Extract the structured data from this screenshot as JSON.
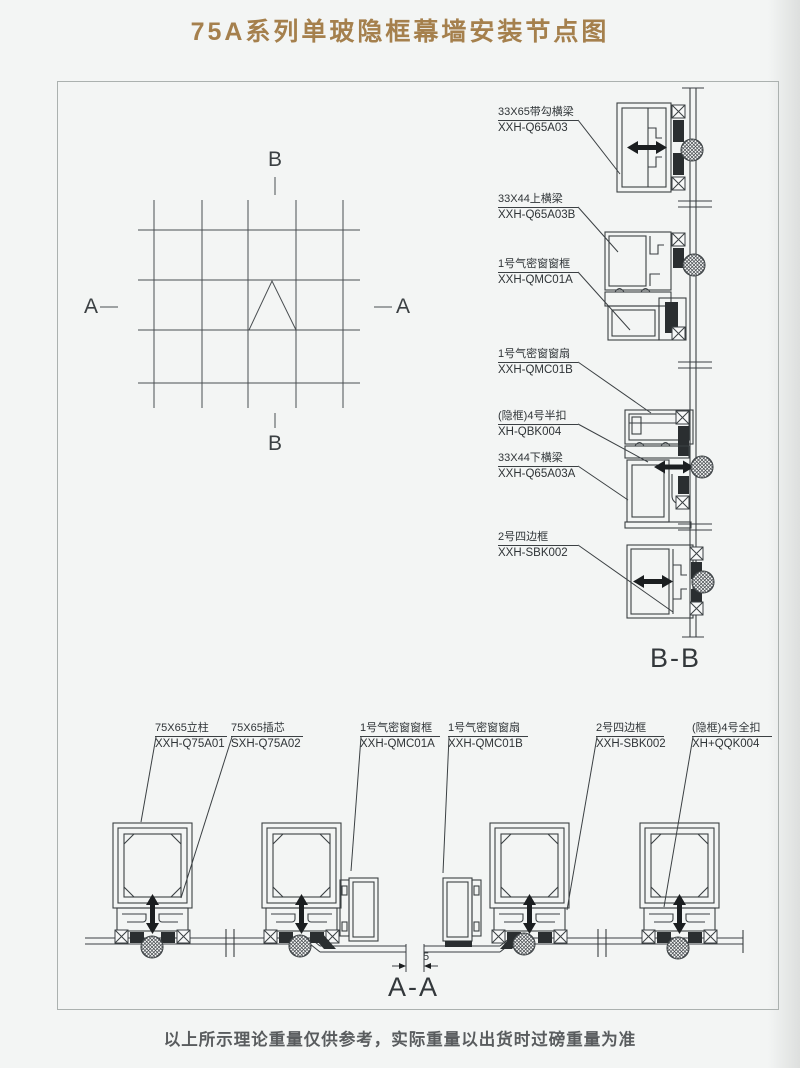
{
  "page": {
    "title": "75A系列单玻隐框幕墙安装节点图",
    "footer": "以上所示理论重量仅供参考，实际重量以出货时过磅重量为准",
    "title_color": "#a5804d",
    "line_color": "#3b4043"
  },
  "plan": {
    "a_left": "A",
    "a_right": "A",
    "b_top": "B",
    "b_bottom": "B"
  },
  "bb": {
    "title": "B-B",
    "labels": [
      {
        "name": "33X65带勾横梁",
        "code": "XXH-Q65A03"
      },
      {
        "name": "33X44上横梁",
        "code": "XXH-Q65A03B"
      },
      {
        "name": "1号气密窗窗框",
        "code": "XXH-QMC01A"
      },
      {
        "name": "1号气密窗窗扇",
        "code": "XXH-QMC01B"
      },
      {
        "name": "(隐框)4号半扣",
        "code": "XH-QBK004"
      },
      {
        "name": "33X44下横梁",
        "code": "XXH-Q65A03A"
      },
      {
        "name": "2号四边框",
        "code": "XXH-SBK002"
      }
    ]
  },
  "aa": {
    "title": "A-A",
    "dimension": "5",
    "labels": [
      {
        "name": "75X65立柱",
        "code": "XXH-Q75A01"
      },
      {
        "name": "75X65插芯",
        "code": "SXH-Q75A02"
      },
      {
        "name": "1号气密窗窗框",
        "code": "XXH-QMC01A"
      },
      {
        "name": "1号气密窗窗扇",
        "code": "XXH-QMC01B"
      },
      {
        "name": "2号四边框",
        "code": "XXH-SBK002"
      },
      {
        "name": "(隐框)4号全扣",
        "code": "XH+QQK004"
      }
    ]
  }
}
